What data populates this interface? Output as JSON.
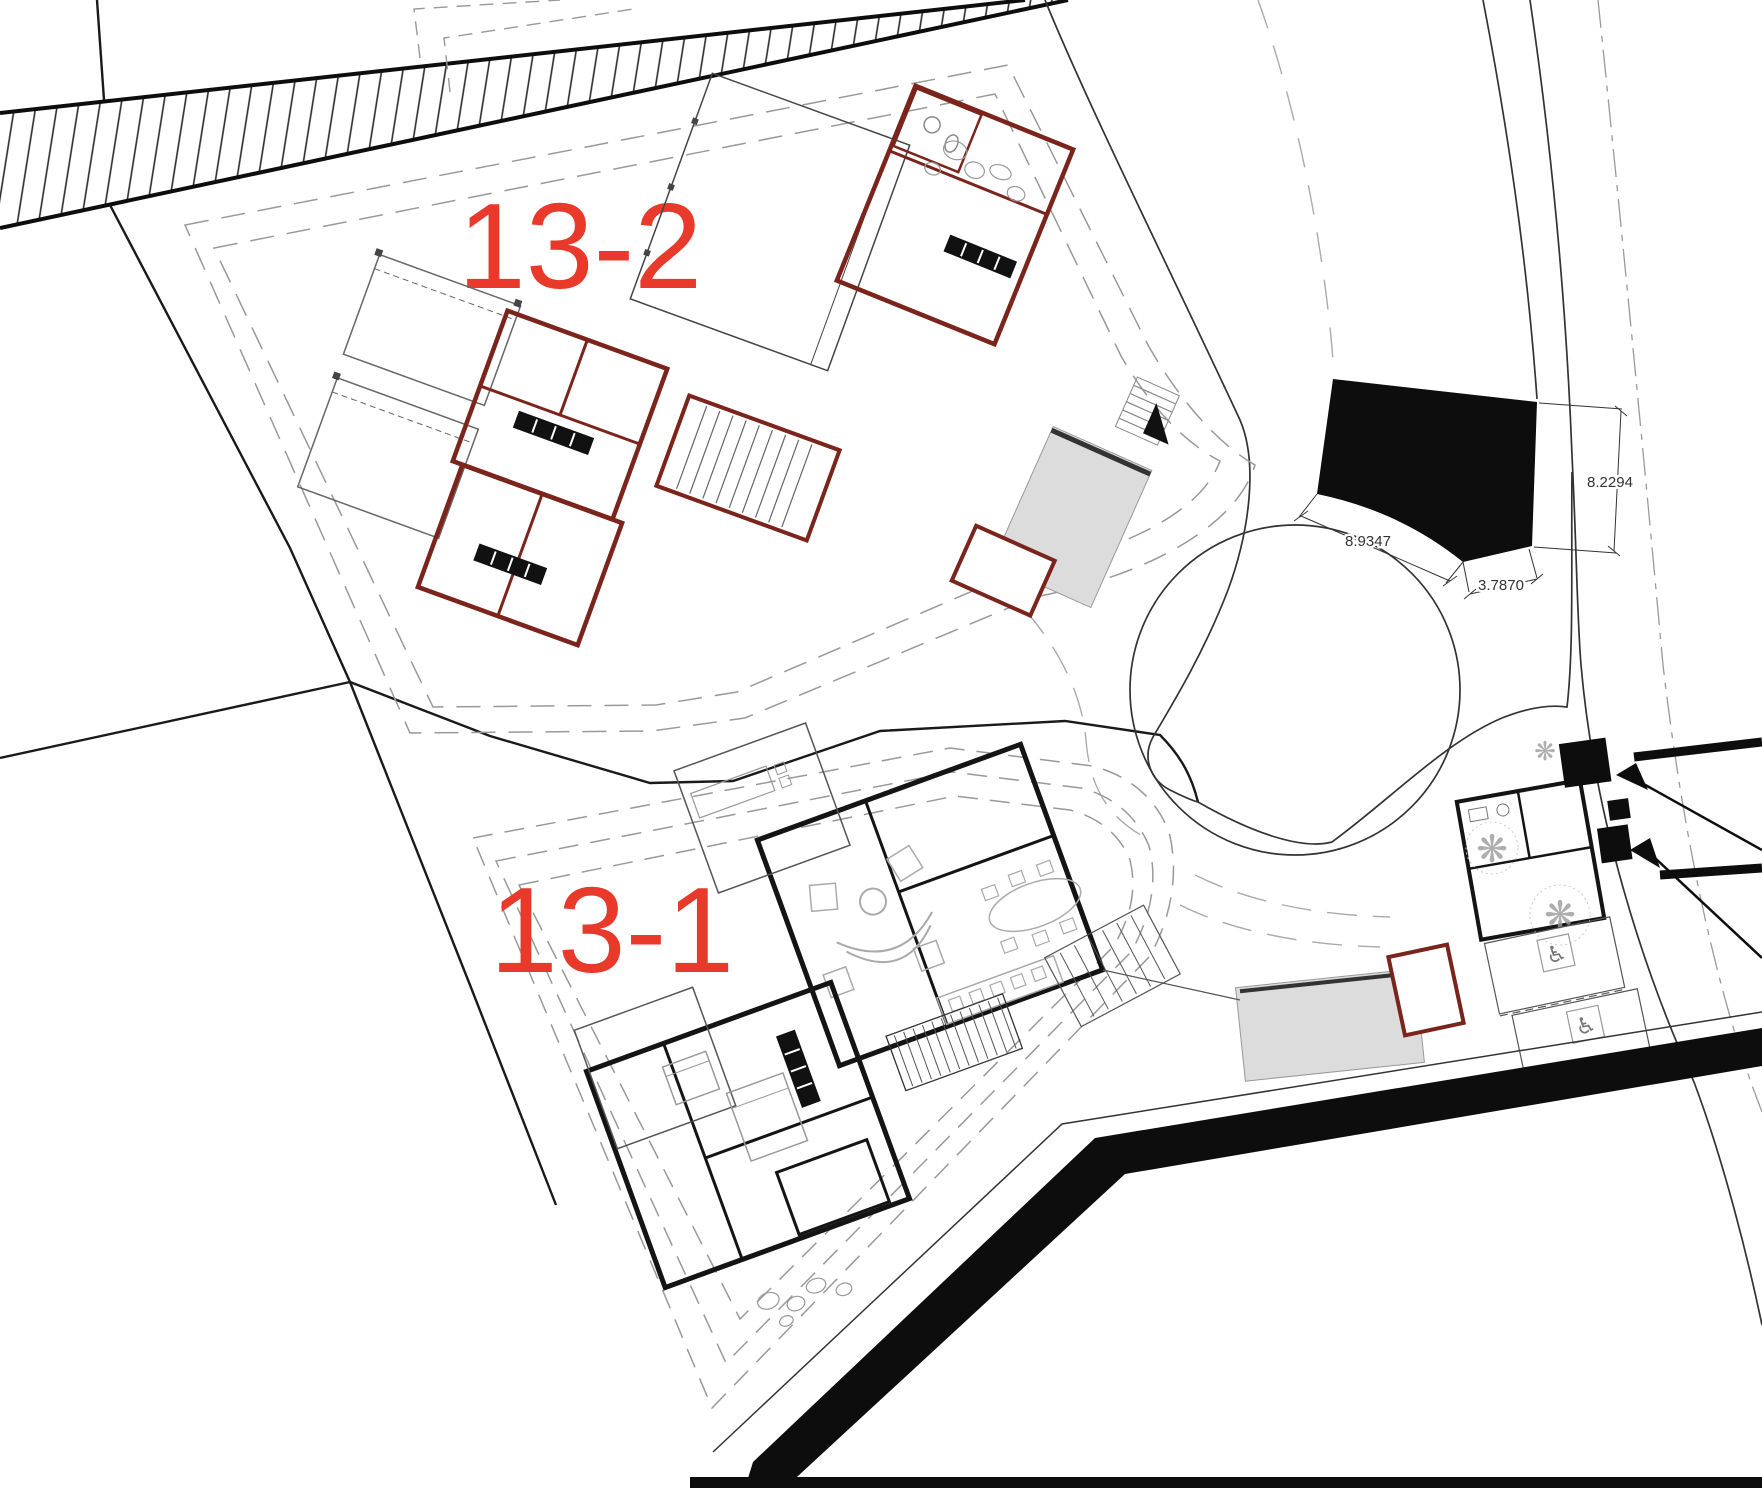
{
  "drawing": {
    "type": "architectural-site-plan",
    "lots": {
      "upper": {
        "label": "13-2"
      },
      "lower": {
        "label": "13-1"
      }
    },
    "dimensions": {
      "curb_arc": "8.9347",
      "curb_short": "3.7870",
      "road_width": "8.2294"
    },
    "colors": {
      "lot_label": "#e8392b",
      "wall_red": "#7b241b",
      "wall_black": "#141414",
      "pool_fill": "#dcdcdc",
      "line_dark": "#1a1a1a",
      "dash_gray": "#999999",
      "solid_black": "#0d0d0d"
    },
    "icons": {
      "accessible_parking": "♿",
      "tree": "❋"
    }
  }
}
